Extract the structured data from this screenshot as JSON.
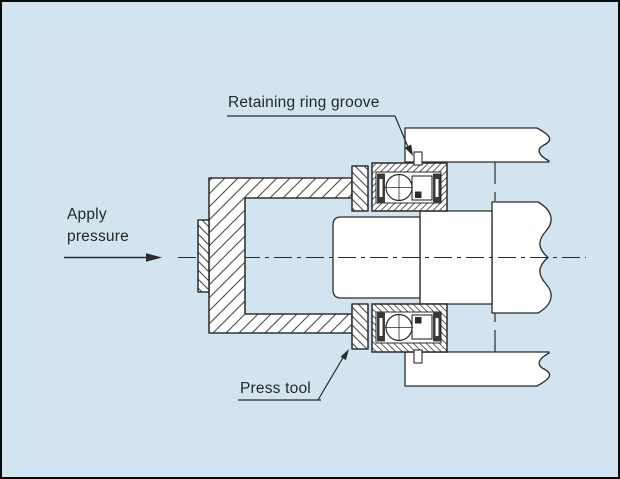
{
  "title": "Bearing press-mounting cross-section diagram",
  "labels": {
    "retaining_ring_groove": "Retaining ring groove",
    "apply_pressure_line1": "Apply",
    "apply_pressure_line2": "pressure",
    "press_tool": "Press tool"
  },
  "icons": {
    "pressure_arrow": "right-arrow",
    "leader_arrowheads": "filled-triangle"
  },
  "colors": {
    "background": "#d2e4f0",
    "line": "#2b2b2b",
    "part_fill": "#ffffff",
    "hatch": "#4a4a4a",
    "text": "#262626",
    "frame": "#0a0a0a"
  }
}
